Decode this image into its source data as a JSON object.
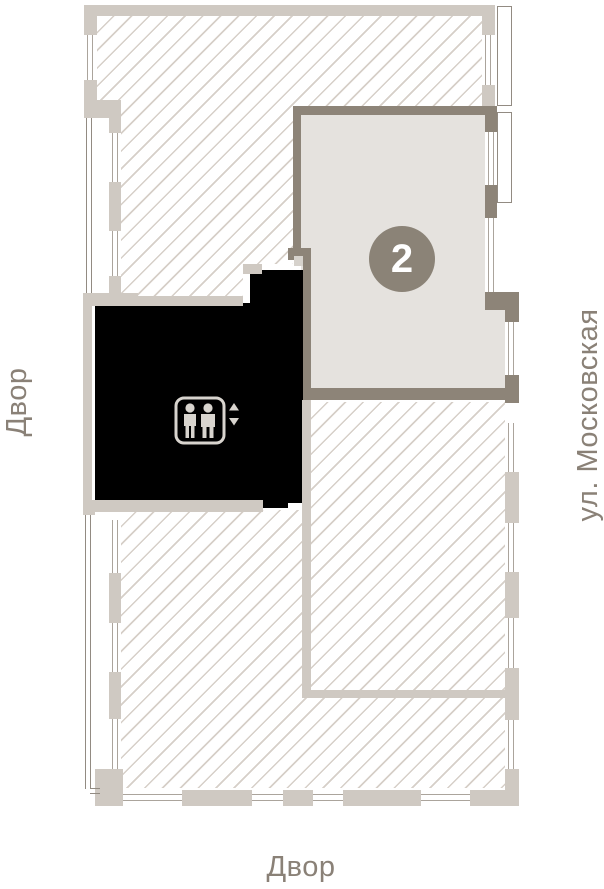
{
  "plan": {
    "selected_unit": {
      "number": "2"
    },
    "labels": {
      "left": "Двор",
      "bottom": "Двор",
      "right": "ул. Московская"
    },
    "icons": {
      "elevator": "elevator-people-icon",
      "up_arrow": "triangle-up",
      "down_arrow": "triangle-down"
    },
    "colors": {
      "wall": "#cfc9c2",
      "selected_wall": "#8d8478",
      "selected_fill": "#e5e2de",
      "core": "#000000",
      "badge": "#8b8377",
      "label_text": "#8a8177",
      "hatch_line": "#d6cfc8",
      "window_line": "#aba49c",
      "balcony_line": "#928b82",
      "icon": "#d8d4ce"
    }
  }
}
